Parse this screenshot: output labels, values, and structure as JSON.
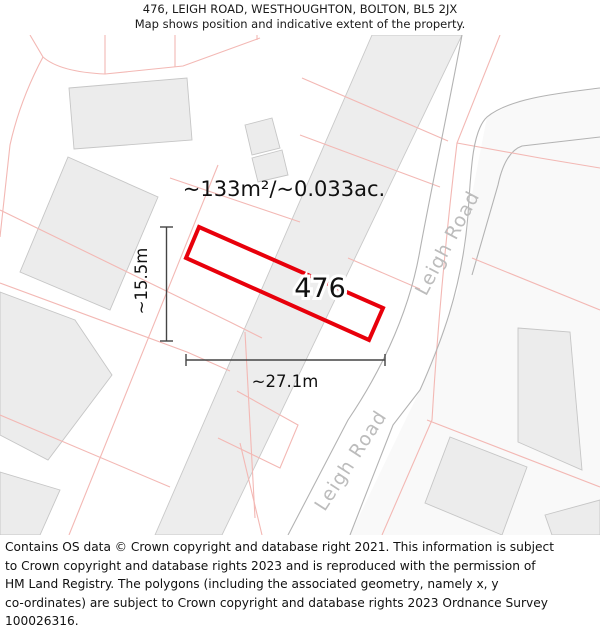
{
  "header": {
    "title": "476, LEIGH ROAD, WESTHOUGHTON, BOLTON, BL5 2JX",
    "subtitle": "Map shows position and indicative extent of the property."
  },
  "map": {
    "area_label": "~133m²/~0.033ac.",
    "plot_number": "476",
    "width_label": "~27.1m",
    "height_label": "~15.5m",
    "road_name_upper": "Leigh Road",
    "road_name_lower": "Leigh Road",
    "colors": {
      "property_outline": "#e8000b",
      "parcel_line": "#f3b8b4",
      "building_fill": "#ececec",
      "road_line": "#b3b3b3",
      "road_label_text": "#bcbcbc",
      "dimension_line": "#444444"
    }
  },
  "footer": {
    "lines": [
      "Contains OS data © Crown copyright and database right 2021. This information is subject",
      "to Crown copyright and database rights 2023 and is reproduced with the permission of",
      "HM Land Registry. The polygons (including the associated geometry, namely x, y",
      "co-ordinates) are subject to Crown copyright and database rights 2023 Ordnance Survey",
      "100026316."
    ]
  }
}
